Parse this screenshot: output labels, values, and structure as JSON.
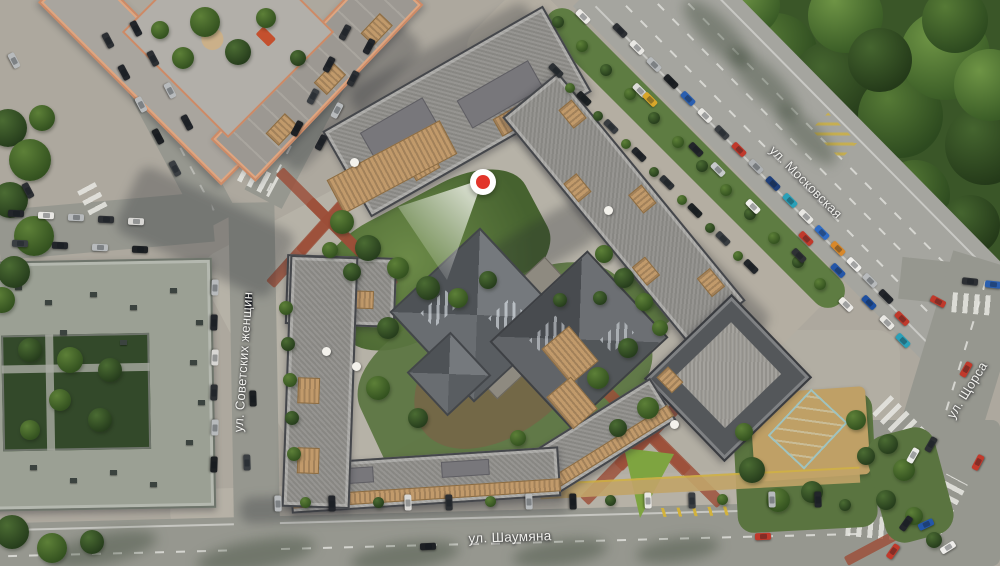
{
  "app": {
    "type": "residential-masterplan-aerial-map"
  },
  "streets": [
    {
      "label": "ул. Советских женщин"
    },
    {
      "label": "ул. Шаумяна"
    },
    {
      "label": "ул. Московская"
    },
    {
      "label": "ул. Щорса"
    }
  ],
  "marker": {
    "kind": "view-point-marker",
    "color": "#e2352b",
    "ring_color": "#ffffff"
  },
  "palette": {
    "pavement": "#b7b2a7",
    "asphalt": "#96978f",
    "forest": "#3a5628",
    "lawn": "#7ea440",
    "roof_gray": "#8f8e8a",
    "roof_dark": "#54575a",
    "roof_sage": "#9ba094",
    "trim_orange": "#cd8a66",
    "terrace_tan": "#c19a6b",
    "path_red": "#9c4e38",
    "pool_teal": "#2e6f72"
  },
  "decor": {
    "cars": [
      [
        583,
        16,
        45,
        "#eceae6"
      ],
      [
        640,
        90,
        45,
        "#dcdcd8"
      ],
      [
        650,
        99,
        45,
        "#d8a62a"
      ],
      [
        696,
        149,
        45,
        "#22252a"
      ],
      [
        718,
        169,
        45,
        "#c6c9ca"
      ],
      [
        753,
        206,
        45,
        "#f0efec"
      ],
      [
        799,
        255,
        45,
        "#2e3134"
      ],
      [
        846,
        304,
        45,
        "#eceae6"
      ],
      [
        620,
        30,
        45,
        "#2c2f33"
      ],
      [
        637,
        47,
        45,
        "#e8e7e3"
      ],
      [
        654,
        64,
        45,
        "#b7babc"
      ],
      [
        671,
        81,
        45,
        "#1d2023"
      ],
      [
        688,
        98,
        45,
        "#2a5fb0"
      ],
      [
        705,
        115,
        45,
        "#e8e7e3"
      ],
      [
        722,
        132,
        45,
        "#3a3e42"
      ],
      [
        739,
        149,
        45,
        "#c0392b"
      ],
      [
        756,
        166,
        45,
        "#aeb1b3"
      ],
      [
        773,
        183,
        45,
        "#1f3f7a"
      ],
      [
        790,
        200,
        45,
        "#2aa0b8"
      ],
      [
        806,
        216,
        45,
        "#e8e7e3"
      ],
      [
        822,
        232,
        45,
        "#2e6bc4"
      ],
      [
        838,
        248,
        45,
        "#d8882a"
      ],
      [
        854,
        264,
        45,
        "#f0efec"
      ],
      [
        870,
        280,
        45,
        "#b7babc"
      ],
      [
        886,
        296,
        45,
        "#22252a"
      ],
      [
        806,
        238,
        45,
        "#c0392b"
      ],
      [
        838,
        270,
        45,
        "#2456a8"
      ],
      [
        869,
        302,
        45,
        "#1d4fa0"
      ],
      [
        887,
        322,
        45,
        "#e8e7e3"
      ],
      [
        903,
        340,
        45,
        "#2aa0b8"
      ],
      [
        902,
        318,
        45,
        "#c0392b"
      ],
      [
        970,
        281,
        6,
        "#2c2f33"
      ],
      [
        993,
        284,
        6,
        "#2a5fb0"
      ],
      [
        938,
        301,
        28,
        "#c0392b"
      ],
      [
        913,
        455,
        -60,
        "#ececea"
      ],
      [
        931,
        444,
        -60,
        "#2c2f33"
      ],
      [
        966,
        369,
        -60,
        "#c0392b"
      ],
      [
        978,
        462,
        -62,
        "#c23a2c"
      ],
      [
        906,
        523,
        -55,
        "#22252a"
      ],
      [
        893,
        551,
        -55,
        "#c0392b"
      ],
      [
        428,
        546,
        -2,
        "#1d2023"
      ],
      [
        763,
        536,
        -2,
        "#c0392b"
      ],
      [
        926,
        524,
        -25,
        "#2456a8"
      ],
      [
        948,
        547,
        -32,
        "#eeedea"
      ],
      [
        278,
        503,
        88,
        "#b7babc"
      ],
      [
        332,
        503,
        88,
        "#22252a"
      ],
      [
        408,
        502,
        88,
        "#d8d7d4"
      ],
      [
        449,
        502,
        88,
        "#2c2f33"
      ],
      [
        529,
        501,
        88,
        "#b7babc"
      ],
      [
        573,
        501,
        88,
        "#1d2023"
      ],
      [
        648,
        500,
        88,
        "#e8e7e3"
      ],
      [
        692,
        500,
        88,
        "#3a3e42"
      ],
      [
        772,
        499,
        88,
        "#b7babc"
      ],
      [
        818,
        499,
        88,
        "#22252a"
      ],
      [
        249,
        302,
        88,
        "#2c2f33"
      ],
      [
        253,
        398,
        88,
        "#1d2023"
      ],
      [
        247,
        462,
        88,
        "#3a3e42"
      ],
      [
        215,
        287,
        92,
        "#b7babc"
      ],
      [
        214,
        322,
        92,
        "#22252a"
      ],
      [
        215,
        357,
        92,
        "#d8d7d4"
      ],
      [
        214,
        392,
        92,
        "#2c2f33"
      ],
      [
        215,
        427,
        92,
        "#b7babc"
      ],
      [
        214,
        464,
        92,
        "#1d2023"
      ],
      [
        16,
        213,
        2,
        "#22252a"
      ],
      [
        46,
        215,
        2,
        "#e8e7e3"
      ],
      [
        76,
        217,
        2,
        "#b7babc"
      ],
      [
        106,
        219,
        2,
        "#2c2f33"
      ],
      [
        136,
        221,
        2,
        "#d8d7d4"
      ],
      [
        20,
        243,
        2,
        "#3a3e42"
      ],
      [
        60,
        245,
        2,
        "#22252a"
      ],
      [
        100,
        247,
        2,
        "#b7babc"
      ],
      [
        140,
        249,
        2,
        "#1d2023"
      ],
      [
        108,
        40,
        62,
        "#2c2f33"
      ],
      [
        124,
        72,
        62,
        "#22252a"
      ],
      [
        141,
        104,
        62,
        "#b7babc"
      ],
      [
        158,
        136,
        62,
        "#1d2023"
      ],
      [
        175,
        168,
        62,
        "#3a3e42"
      ],
      [
        136,
        28,
        62,
        "#22252a"
      ],
      [
        153,
        58,
        62,
        "#2c2f33"
      ],
      [
        170,
        90,
        62,
        "#b7babc"
      ],
      [
        187,
        122,
        62,
        "#22252a"
      ],
      [
        28,
        190,
        62,
        "#2c2f33"
      ],
      [
        14,
        60,
        62,
        "#b7babc"
      ],
      [
        345,
        32,
        -62,
        "#2c2f33"
      ],
      [
        329,
        64,
        -62,
        "#22252a"
      ],
      [
        313,
        96,
        -62,
        "#3a3e42"
      ],
      [
        297,
        128,
        -62,
        "#1d2023"
      ],
      [
        369,
        46,
        -62,
        "#22252a"
      ],
      [
        353,
        78,
        -62,
        "#2c2f33"
      ],
      [
        337,
        110,
        -62,
        "#b7babc"
      ],
      [
        321,
        142,
        -62,
        "#22252a"
      ],
      [
        556,
        70,
        45,
        "#2c3034"
      ],
      [
        584,
        98,
        45,
        "#1e2224"
      ],
      [
        611,
        126,
        45,
        "#383c40"
      ],
      [
        639,
        154,
        45,
        "#22262a"
      ],
      [
        667,
        182,
        45,
        "#2c3034"
      ],
      [
        695,
        210,
        45,
        "#1e2224"
      ],
      [
        723,
        238,
        45,
        "#383c40"
      ],
      [
        751,
        266,
        45,
        "#22262a"
      ]
    ],
    "trees": [
      [
        8,
        128,
        38,
        0
      ],
      [
        30,
        160,
        42,
        1
      ],
      [
        10,
        200,
        36,
        0
      ],
      [
        34,
        236,
        40,
        1
      ],
      [
        14,
        272,
        32,
        0
      ],
      [
        42,
        118,
        26,
        1
      ],
      [
        2,
        300,
        26,
        1
      ],
      [
        12,
        532,
        34,
        0
      ],
      [
        52,
        548,
        30,
        1
      ],
      [
        92,
        542,
        24,
        0
      ],
      [
        205,
        22,
        30,
        1
      ],
      [
        238,
        52,
        26,
        0
      ],
      [
        183,
        58,
        22,
        1
      ],
      [
        266,
        18,
        20,
        1
      ],
      [
        298,
        58,
        16,
        0
      ],
      [
        160,
        30,
        18,
        1
      ],
      [
        342,
        222,
        24,
        1
      ],
      [
        368,
        248,
        26,
        0
      ],
      [
        398,
        268,
        22,
        1
      ],
      [
        428,
        288,
        24,
        0
      ],
      [
        352,
        272,
        18,
        0
      ],
      [
        458,
        298,
        20,
        1
      ],
      [
        488,
        280,
        18,
        0
      ],
      [
        330,
        250,
        16,
        1
      ],
      [
        388,
        328,
        22,
        0
      ],
      [
        378,
        388,
        24,
        1
      ],
      [
        418,
        418,
        20,
        0
      ],
      [
        598,
        378,
        22,
        1
      ],
      [
        628,
        348,
        20,
        0
      ],
      [
        648,
        408,
        22,
        1
      ],
      [
        618,
        428,
        18,
        0
      ],
      [
        518,
        438,
        16,
        1
      ],
      [
        560,
        300,
        14,
        0
      ],
      [
        604,
        254,
        18,
        1
      ],
      [
        624,
        278,
        20,
        0
      ],
      [
        644,
        302,
        18,
        1
      ],
      [
        600,
        298,
        14,
        0
      ],
      [
        660,
        328,
        16,
        1
      ],
      [
        286,
        308,
        14,
        1
      ],
      [
        288,
        344,
        14,
        0
      ],
      [
        290,
        380,
        14,
        1
      ],
      [
        292,
        418,
        14,
        0
      ],
      [
        294,
        454,
        14,
        1
      ],
      [
        558,
        22,
        12,
        0
      ],
      [
        582,
        46,
        12,
        1
      ],
      [
        606,
        70,
        12,
        0
      ],
      [
        630,
        94,
        12,
        1
      ],
      [
        654,
        118,
        12,
        0
      ],
      [
        678,
        142,
        12,
        1
      ],
      [
        702,
        166,
        12,
        0
      ],
      [
        726,
        190,
        12,
        1
      ],
      [
        750,
        214,
        12,
        0
      ],
      [
        774,
        238,
        12,
        1
      ],
      [
        798,
        262,
        12,
        0
      ],
      [
        820,
        284,
        12,
        1
      ],
      [
        570,
        88,
        10,
        1
      ],
      [
        598,
        116,
        10,
        0
      ],
      [
        626,
        144,
        10,
        1
      ],
      [
        654,
        172,
        10,
        0
      ],
      [
        682,
        200,
        10,
        1
      ],
      [
        710,
        228,
        10,
        0
      ],
      [
        738,
        256,
        10,
        1
      ],
      [
        752,
        470,
        26,
        0
      ],
      [
        778,
        500,
        24,
        1
      ],
      [
        812,
        492,
        22,
        0
      ],
      [
        856,
        420,
        20,
        1
      ],
      [
        866,
        456,
        18,
        0
      ],
      [
        744,
        432,
        18,
        1
      ],
      [
        888,
        444,
        20,
        0
      ],
      [
        904,
        470,
        22,
        1
      ],
      [
        886,
        500,
        20,
        0
      ],
      [
        914,
        516,
        18,
        1
      ],
      [
        934,
        540,
        16,
        0
      ],
      [
        305,
        502,
        11,
        1
      ],
      [
        378,
        502,
        11,
        0
      ],
      [
        490,
        501,
        11,
        1
      ],
      [
        610,
        500,
        11,
        0
      ],
      [
        722,
        499,
        11,
        1
      ],
      [
        845,
        505,
        12,
        0
      ],
      [
        30,
        350,
        24,
        0
      ],
      [
        70,
        360,
        26,
        1
      ],
      [
        110,
        370,
        24,
        0
      ],
      [
        60,
        400,
        22,
        1
      ],
      [
        100,
        420,
        24,
        0
      ],
      [
        30,
        430,
        20,
        1
      ]
    ],
    "forest_blobs": [
      [
        40,
        5,
        70,
        1
      ],
      [
        110,
        25,
        80,
        0
      ],
      [
        175,
        55,
        85,
        1
      ],
      [
        235,
        85,
        90,
        0
      ],
      [
        300,
        115,
        85,
        1
      ],
      [
        345,
        55,
        90,
        2
      ],
      [
        385,
        145,
        80,
        0
      ],
      [
        245,
        15,
        75,
        2
      ],
      [
        315,
        195,
        70,
        1
      ],
      [
        370,
        225,
        60,
        0
      ],
      [
        150,
        5,
        60,
        2
      ],
      [
        95,
        75,
        50,
        0
      ],
      [
        355,
        20,
        66,
        1
      ],
      [
        390,
        85,
        72,
        2
      ],
      [
        280,
        60,
        64,
        0
      ],
      [
        205,
        130,
        58,
        1
      ]
    ],
    "vents": [
      [
        15,
        285
      ],
      [
        45,
        300
      ],
      [
        90,
        292
      ],
      [
        130,
        305
      ],
      [
        170,
        288
      ],
      [
        196,
        320
      ],
      [
        190,
        360
      ],
      [
        198,
        400
      ],
      [
        186,
        440
      ],
      [
        30,
        465
      ],
      [
        70,
        478
      ],
      [
        110,
        470
      ],
      [
        150,
        482
      ],
      [
        60,
        330
      ],
      [
        120,
        340
      ]
    ]
  }
}
